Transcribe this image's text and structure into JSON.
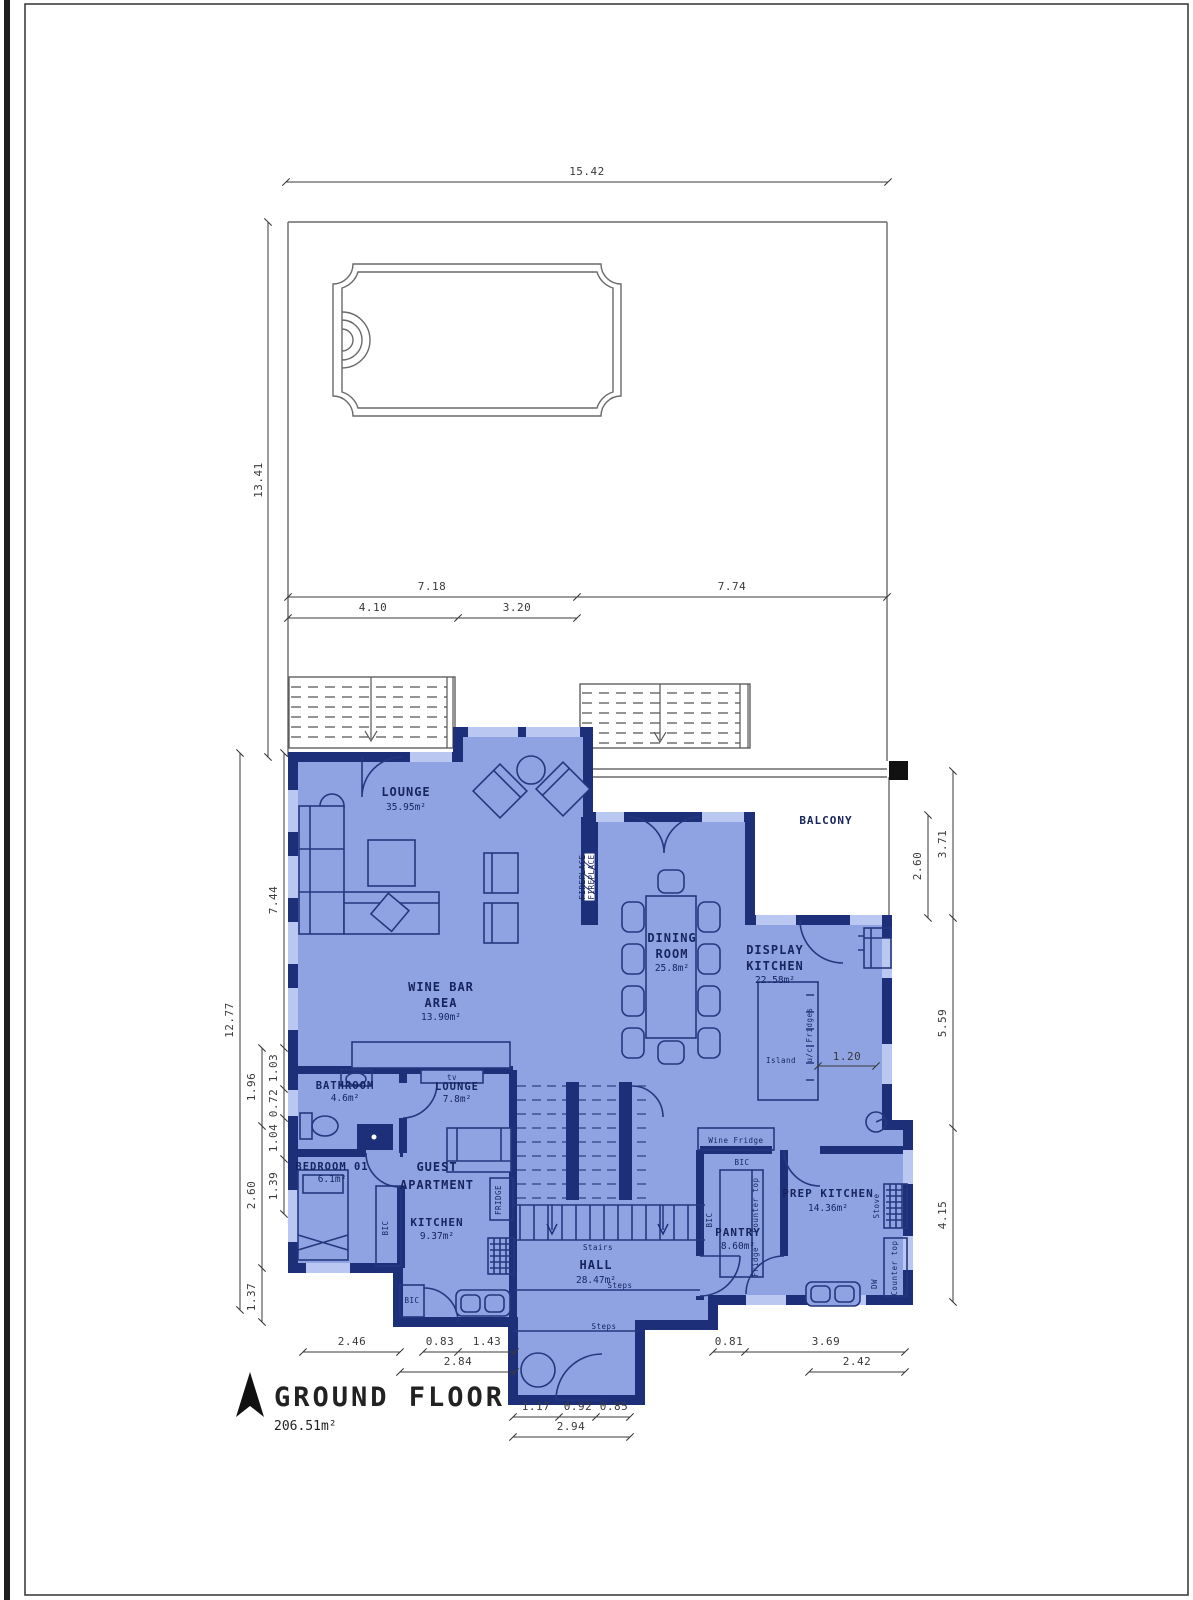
{
  "title": {
    "label": "GROUND FLOOR",
    "area": "206.51m²"
  },
  "rooms": {
    "lounge": {
      "name": "LOUNGE",
      "area": "35.95m²"
    },
    "balcony": {
      "name": "BALCONY"
    },
    "dining": {
      "l1": "DINING",
      "l2": "ROOM",
      "area": "25.8m²"
    },
    "display_kitchen": {
      "l1": "DISPLAY",
      "l2": "KITCHEN",
      "area": "22.58m²"
    },
    "wine_bar": {
      "l1": "WINE BAR",
      "l2": "AREA",
      "area": "13.90m²"
    },
    "bathroom": {
      "name": "BATHROOM",
      "area": "4.6m²"
    },
    "guest_lounge": {
      "name": "LOUNGE",
      "area": "7.8m²"
    },
    "bedroom": {
      "name": "BEDROOM 01",
      "area": "6.1m²"
    },
    "guest_apartment": {
      "l1": "GUEST",
      "l2": "APARTMENT"
    },
    "guest_kitchen": {
      "name": "KITCHEN",
      "area": "9.37m²"
    },
    "hall": {
      "name": "HALL",
      "area": "28.47m²"
    },
    "pantry": {
      "name": "PANTRY",
      "area": "8.60m²"
    },
    "prep_kitchen": {
      "name": "PREP KITCHEN",
      "area": "14.36m²"
    }
  },
  "fixtures": {
    "tv": "tv",
    "fireplace": "FIREPLACE",
    "wine_fridge": "Wine Fridge",
    "bic": "BIC",
    "fridge_upper": "FRIDGE",
    "fridge": "Fridge",
    "counter_top": "Counter top",
    "stove": "Stove",
    "dw": "DW",
    "uc_fridges": "u/c Fridges",
    "island": "Island",
    "stairs": "Stairs",
    "steps": "Steps"
  },
  "dims": {
    "plot_width": "15.42",
    "plot_height": "13.41",
    "top_left": "7.18",
    "top_right": "7.74",
    "top_sub_left": "4.10",
    "top_sub_right": "3.20",
    "west_lounge": "7.44",
    "west_total": "12.77",
    "west_a": "1.03",
    "west_b": "1.96",
    "west_c": "0.72",
    "west_d": "1.04",
    "west_e": "2.60",
    "west_f": "1.39",
    "west_g": "1.37",
    "east_outer": "3.71",
    "east_inner": "2.60",
    "east_mid": "5.59",
    "east_low": "4.15",
    "island": "1.20",
    "south_a": "2.46",
    "south_b": "0.83",
    "south_c": "1.43",
    "south_d": "2.84",
    "entry_a": "1.17",
    "entry_b": "0.92",
    "entry_c": "0.85",
    "entry_d": "2.94",
    "south_e": "0.81",
    "south_f": "3.69",
    "south_g": "2.42"
  },
  "colors": {
    "room_fill": "#8fa3e2",
    "wall": "#1d2f78",
    "window": "#bac7f0",
    "dim_line": "#3a3a3a"
  }
}
